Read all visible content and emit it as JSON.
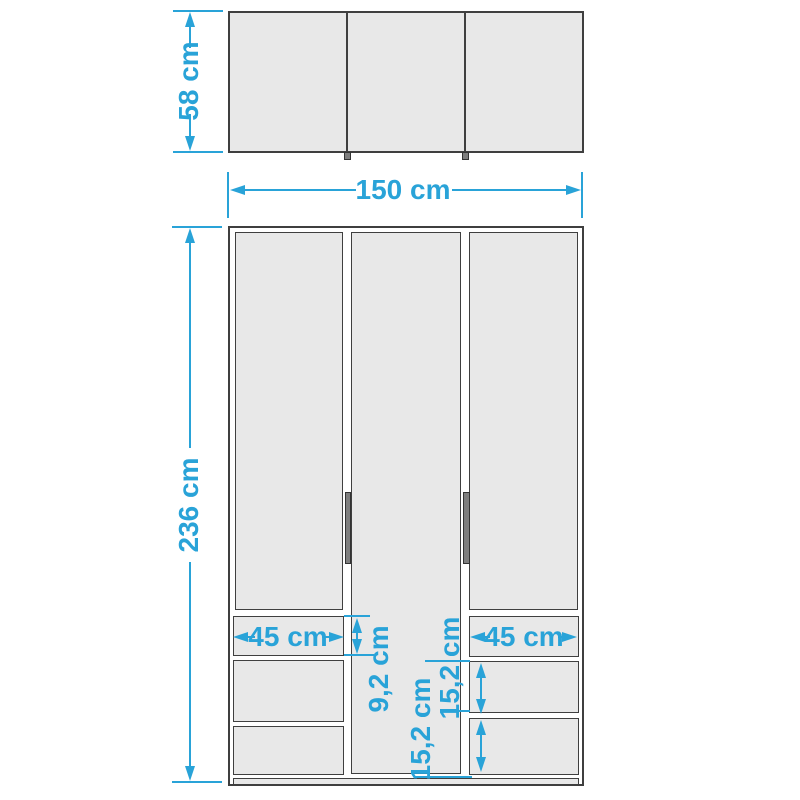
{
  "colors": {
    "accent": "#29a3d8",
    "outline": "#3f3f3f",
    "panel_fill": "#e8e8e8",
    "handle_fill": "#7e7e7e"
  },
  "top_view": {
    "depth": "58 cm",
    "width": "150 cm"
  },
  "front_view": {
    "height": "236 cm",
    "left_drawer_width": "45 cm",
    "right_drawer_width": "45 cm",
    "top_drawer_height": "9,2 cm",
    "middle_drawer_height": "15,2 cm",
    "bottom_drawer_height": "15,2 cm"
  }
}
